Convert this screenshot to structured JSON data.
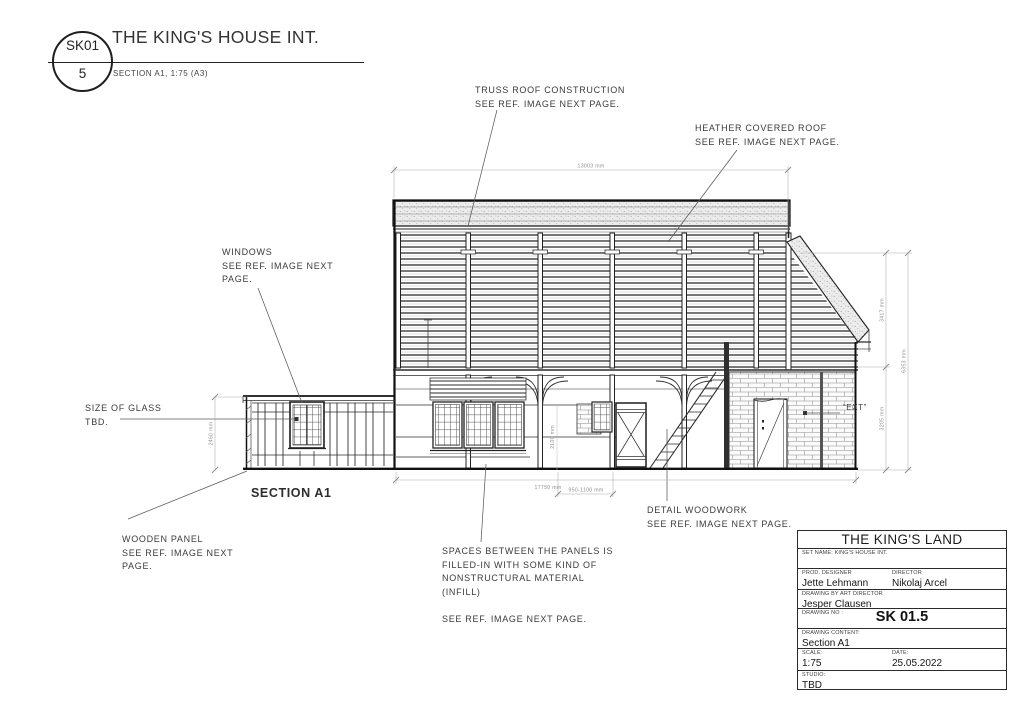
{
  "header": {
    "bubble_top": "SK01",
    "bubble_bottom": "5",
    "title": "THE KING'S HOUSE INT.",
    "subtitle": "SECTION A1, 1:75 (A3)"
  },
  "annotations": {
    "truss_roof": "TRUSS ROOF CONSTRUCTION\nSEE REF. IMAGE NEXT PAGE.",
    "heather_roof": "HEATHER COVERED ROOF\nSEE REF. IMAGE NEXT PAGE.",
    "windows": "WINDOWS\nSEE REF. IMAGE NEXT\nPAGE.",
    "size_of_glass": "SIZE OF GLASS\nTBD.",
    "wooden_panel": "WOODEN PANEL\nSEE REF. IMAGE NEXT\nPAGE.",
    "infill": "SPACES BETWEEN THE PANELS IS\nFILLED-IN WITH SOME KIND OF\nNONSTRUCTURAL MATERIAL\n(INFILL)\n\nSEE REF. IMAGE NEXT PAGE.",
    "detail_woodwork": "DETAIL WOODWORK\nSEE REF. IMAGE NEXT PAGE.",
    "ext": "“EXT”",
    "section_label": "SECTION A1"
  },
  "dimensions": {
    "top_width": "13003 mm",
    "bottom_width": "17750 mm",
    "door_width": "950-1100 mm",
    "left_height": "2460 mm",
    "mid_height": "2100 mm",
    "right_upper": "3417 mm",
    "right_lower": "3205 mm",
    "right_total": "6353 mm"
  },
  "title_block": {
    "project": "THE KING'S LAND",
    "set_name_label": "SET NAME: KING'S HOUSE INT.",
    "prod_designer_label": "PROD. DESIGNER",
    "prod_designer": "Jette Lehmann",
    "director_label": "DIRECTOR",
    "director": "Nikolaj Arcel",
    "art_director_label": "DRAWING BY ART DIRECTOR",
    "art_director": "Jesper Clausen",
    "drawing_no_label": "DRAWING NO :",
    "drawing_no": "SK 01.5",
    "content_label": "DRAWING CONTENT:",
    "content": "Section A1",
    "scale_label": "SCALE:",
    "scale": "1:75",
    "date_label": "DATE:",
    "date": "25.05.2022",
    "studio_label": "STUDIO:",
    "studio": "TBD"
  },
  "colors": {
    "line": "#2b2b2b",
    "dim": "#9a9a9a",
    "text": "#3b3b3b"
  }
}
